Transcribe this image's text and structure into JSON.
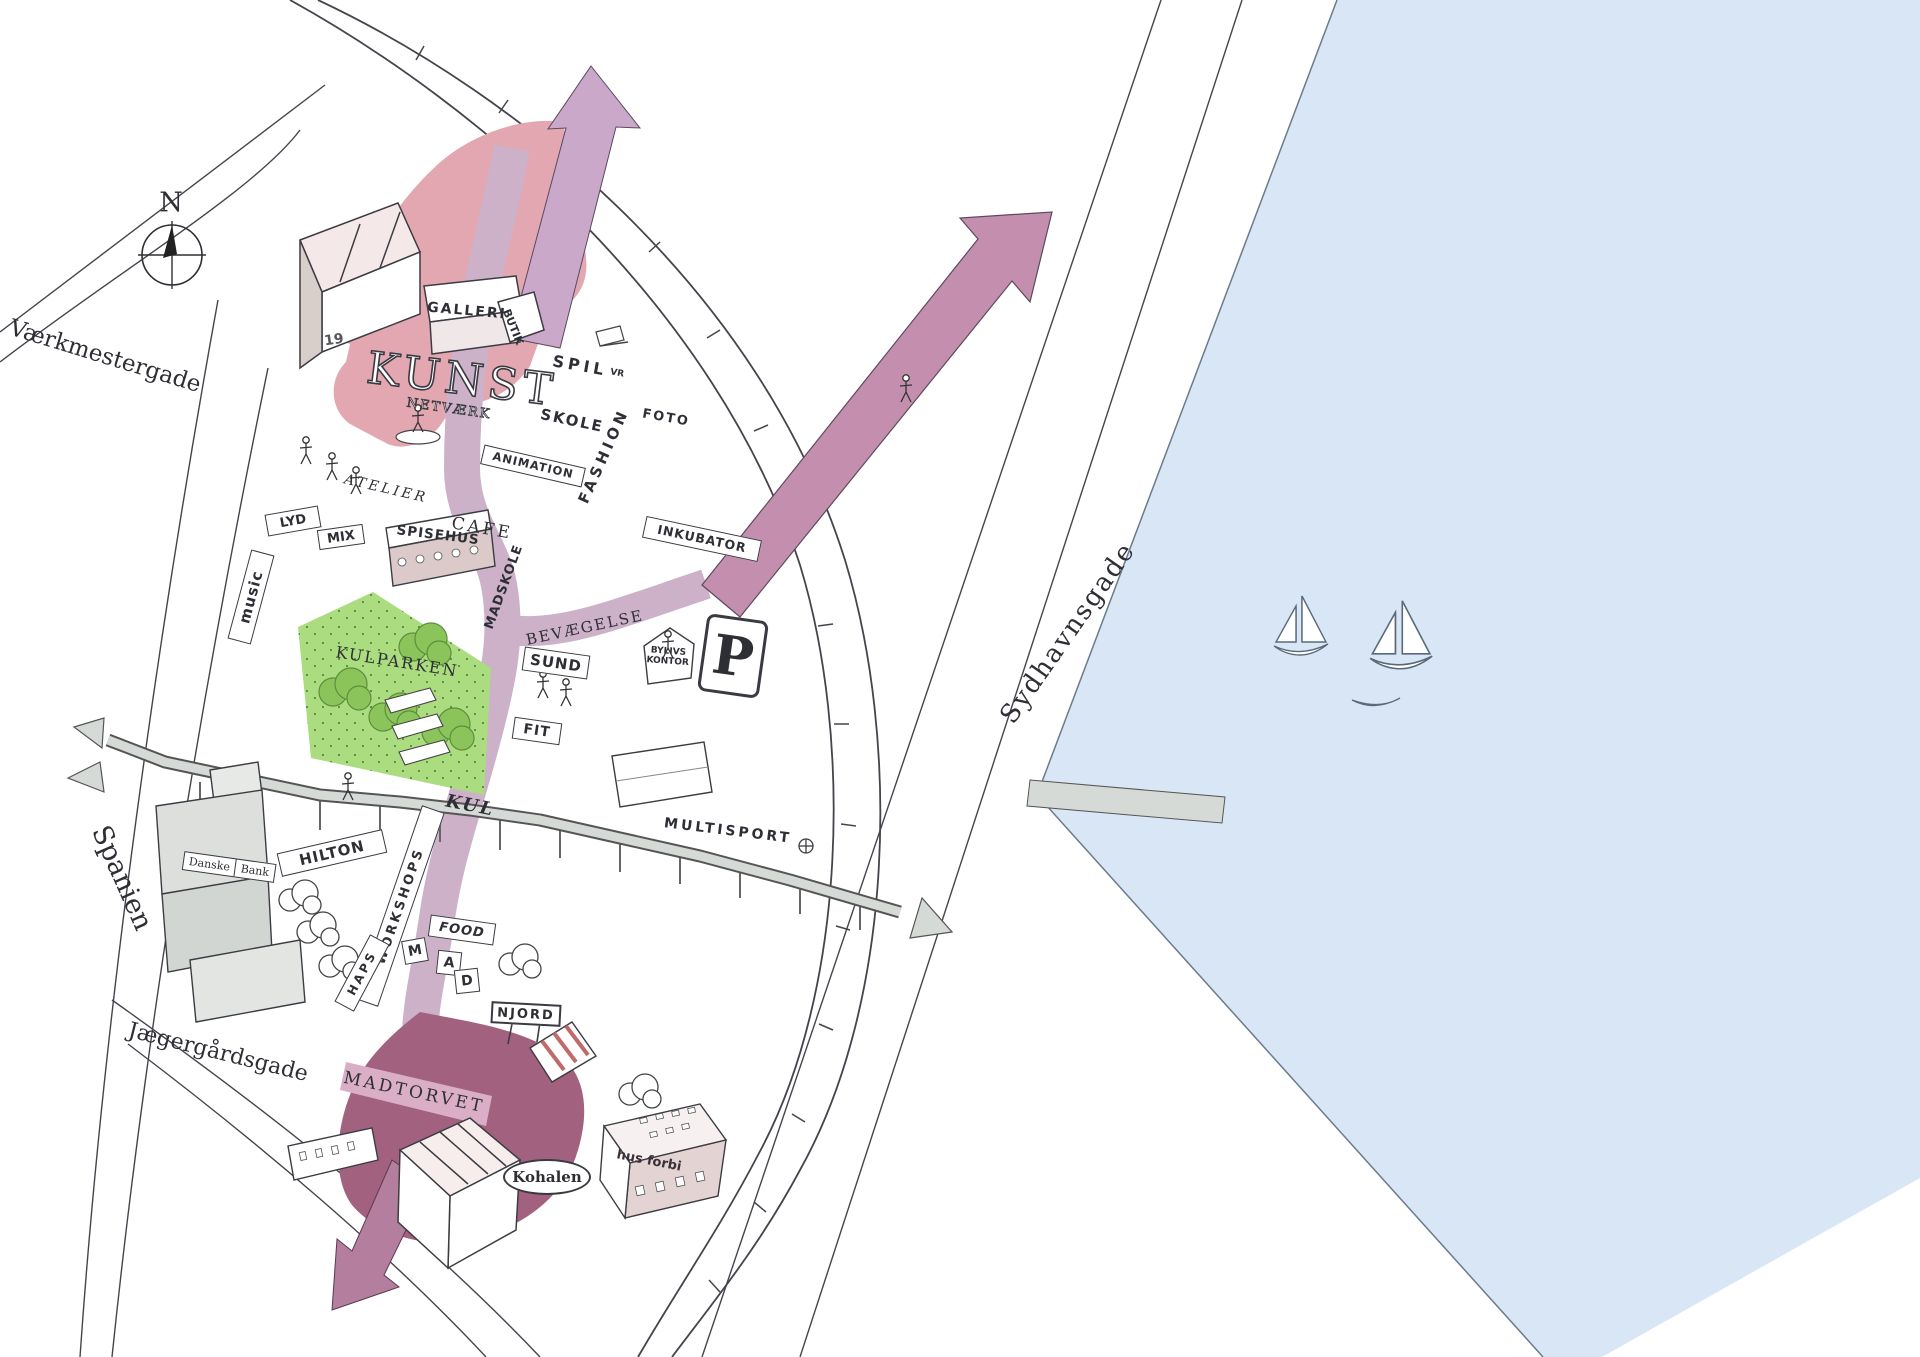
{
  "compass": {
    "north": "N"
  },
  "streets": {
    "vaerkmestergade": "Værkmestergade",
    "spanien": "Spanien",
    "jaegergaardsgade": "Jægergårdsgade",
    "sydhavnsgade": "Sydhavnsgade"
  },
  "districts": {
    "kunst_title": "KUNST",
    "kunst_subtitle": "NETVÆRK",
    "kulparken": "KULPARKEN",
    "madtorvet": "MADTORVET"
  },
  "flows": {
    "bevaegelse": "BEVÆGELSE",
    "kul": "KUL",
    "multisport": "MULTISPORT"
  },
  "places": {
    "galleri": "GALLERI",
    "butik": "BUTIK",
    "spil": "SPIL",
    "vr": "VR",
    "skole": "SKOLE",
    "animation": "ANIMATION",
    "fashion": "FASHION",
    "foto": "FOTO",
    "atelier": "ATELIER",
    "inkubator": "INKUBATOR",
    "lyd": "LYD",
    "mix": "MIX",
    "music": "music",
    "spisehus": "SPISEHUS",
    "cafe": "CAFE",
    "madskole": "MADSKOLE",
    "sund": "SUND",
    "fit": "FIT",
    "bylivs_line1": "BYLIVS",
    "bylivs_line2": "KONTOR",
    "parking": "P",
    "hilton": "HILTON",
    "building_number": "19",
    "danske_bank_line1": "Danske",
    "danske_bank_line2": "Bank",
    "food": "FOOD",
    "njord": "NJORD",
    "kohalen": "Kohalen",
    "hus_forbi": "hus forbi"
  },
  "letter_signs": {
    "workshops": "WORKSHOPS",
    "haps": "HAPS",
    "mad": [
      "M",
      "A",
      "D"
    ]
  },
  "colors": {
    "water": "#d9e6f5",
    "kunst_pink": "#e2a7b1",
    "flow_purple": "#ccb1c9",
    "arrow_mauve": "#c48fae",
    "madtorvet_maroon": "#a2617f",
    "park_green": "#abdc80",
    "tree_green": "#8cc45c",
    "road_gray": "#d6dad6"
  }
}
